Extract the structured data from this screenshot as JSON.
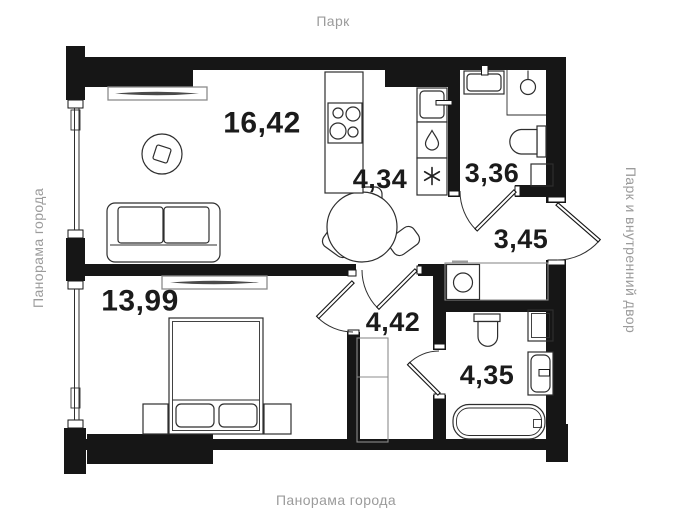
{
  "plan": {
    "type": "apartment-floor-plan",
    "surroundings": {
      "top": "Парк",
      "left": "Панорама города",
      "right": "Парк и внутренний двор",
      "bottom": "Панорама города"
    },
    "rooms": {
      "living": {
        "name": "living-room",
        "area": "16,42"
      },
      "kitchen": {
        "name": "kitchen",
        "area": "4,34"
      },
      "bath_small": {
        "name": "bathroom-small",
        "area": "3,36"
      },
      "hall_entry": {
        "name": "entry-hallway",
        "area": "3,45"
      },
      "bedroom": {
        "name": "bedroom",
        "area": "13,99"
      },
      "hall_inner": {
        "name": "inner-hallway",
        "area": "4,42"
      },
      "bath_main": {
        "name": "bathroom-main",
        "area": "4,35"
      }
    },
    "colors": {
      "wall": "#161616",
      "line": "#2e2e2e",
      "muted_text": "#9b9b9b",
      "label_text": "#1b1b1b",
      "radiator": "#8c8c8c",
      "background": "#ffffff"
    }
  }
}
